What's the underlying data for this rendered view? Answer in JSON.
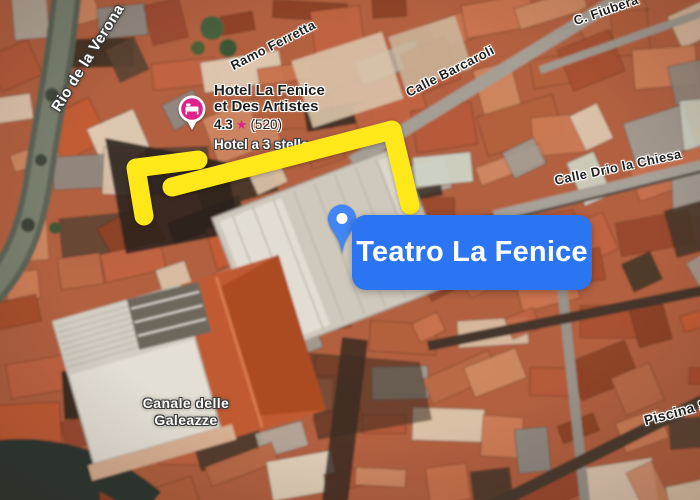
{
  "destination": {
    "label": "Teatro La Fenice"
  },
  "hotel": {
    "name_line1": "Hotel La Fenice",
    "name_line2": "et Des Artistes",
    "rating": "4.3",
    "star": "★",
    "review_count": "(520)",
    "category": "Hotel a 3 stelle"
  },
  "street_labels": {
    "rio": "Rio de la Verona",
    "ramo": "Ramo Ferretta",
    "barcaroli": "Calle Barcaroli",
    "fiubera": "C. Fiubera",
    "drio": "Calle Drio la Chiesa",
    "canale_line1": "Canale delle",
    "canale_line2": "Galeazze",
    "piscina": "Piscina S"
  },
  "colors": {
    "arrow_yellow": "#FFE81A",
    "label_blue": "#2B74F2",
    "pin_blue": "#4285F4",
    "pin_inner_white": "#FFFFFF",
    "hotel_pink": "#E0218A"
  }
}
